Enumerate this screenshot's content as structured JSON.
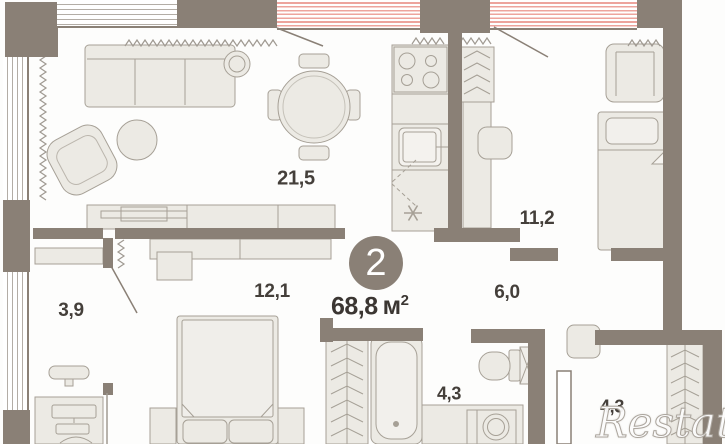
{
  "badge": {
    "rooms_count": "2",
    "area_value": "68,8",
    "area_unit": "м",
    "area_superscript": "2"
  },
  "room_labels": {
    "living": "21,5",
    "bedroom_right": "11,2",
    "bedroom_left": "12,1",
    "cabinet": "3,9",
    "hallway": "6,0",
    "bathroom": "4,3",
    "wardrobe": "4,3"
  },
  "watermark": "Restate",
  "colors": {
    "wall": "#8a8076",
    "furniture_fill": "#eceae4",
    "furniture_stroke": "#a6a096",
    "window_red_stripe": "#eda49d",
    "glazing_line": "#b3ada6",
    "label_text": "#443f3a",
    "badge_background": "#8a8076",
    "badge_text": "#ffffff"
  }
}
